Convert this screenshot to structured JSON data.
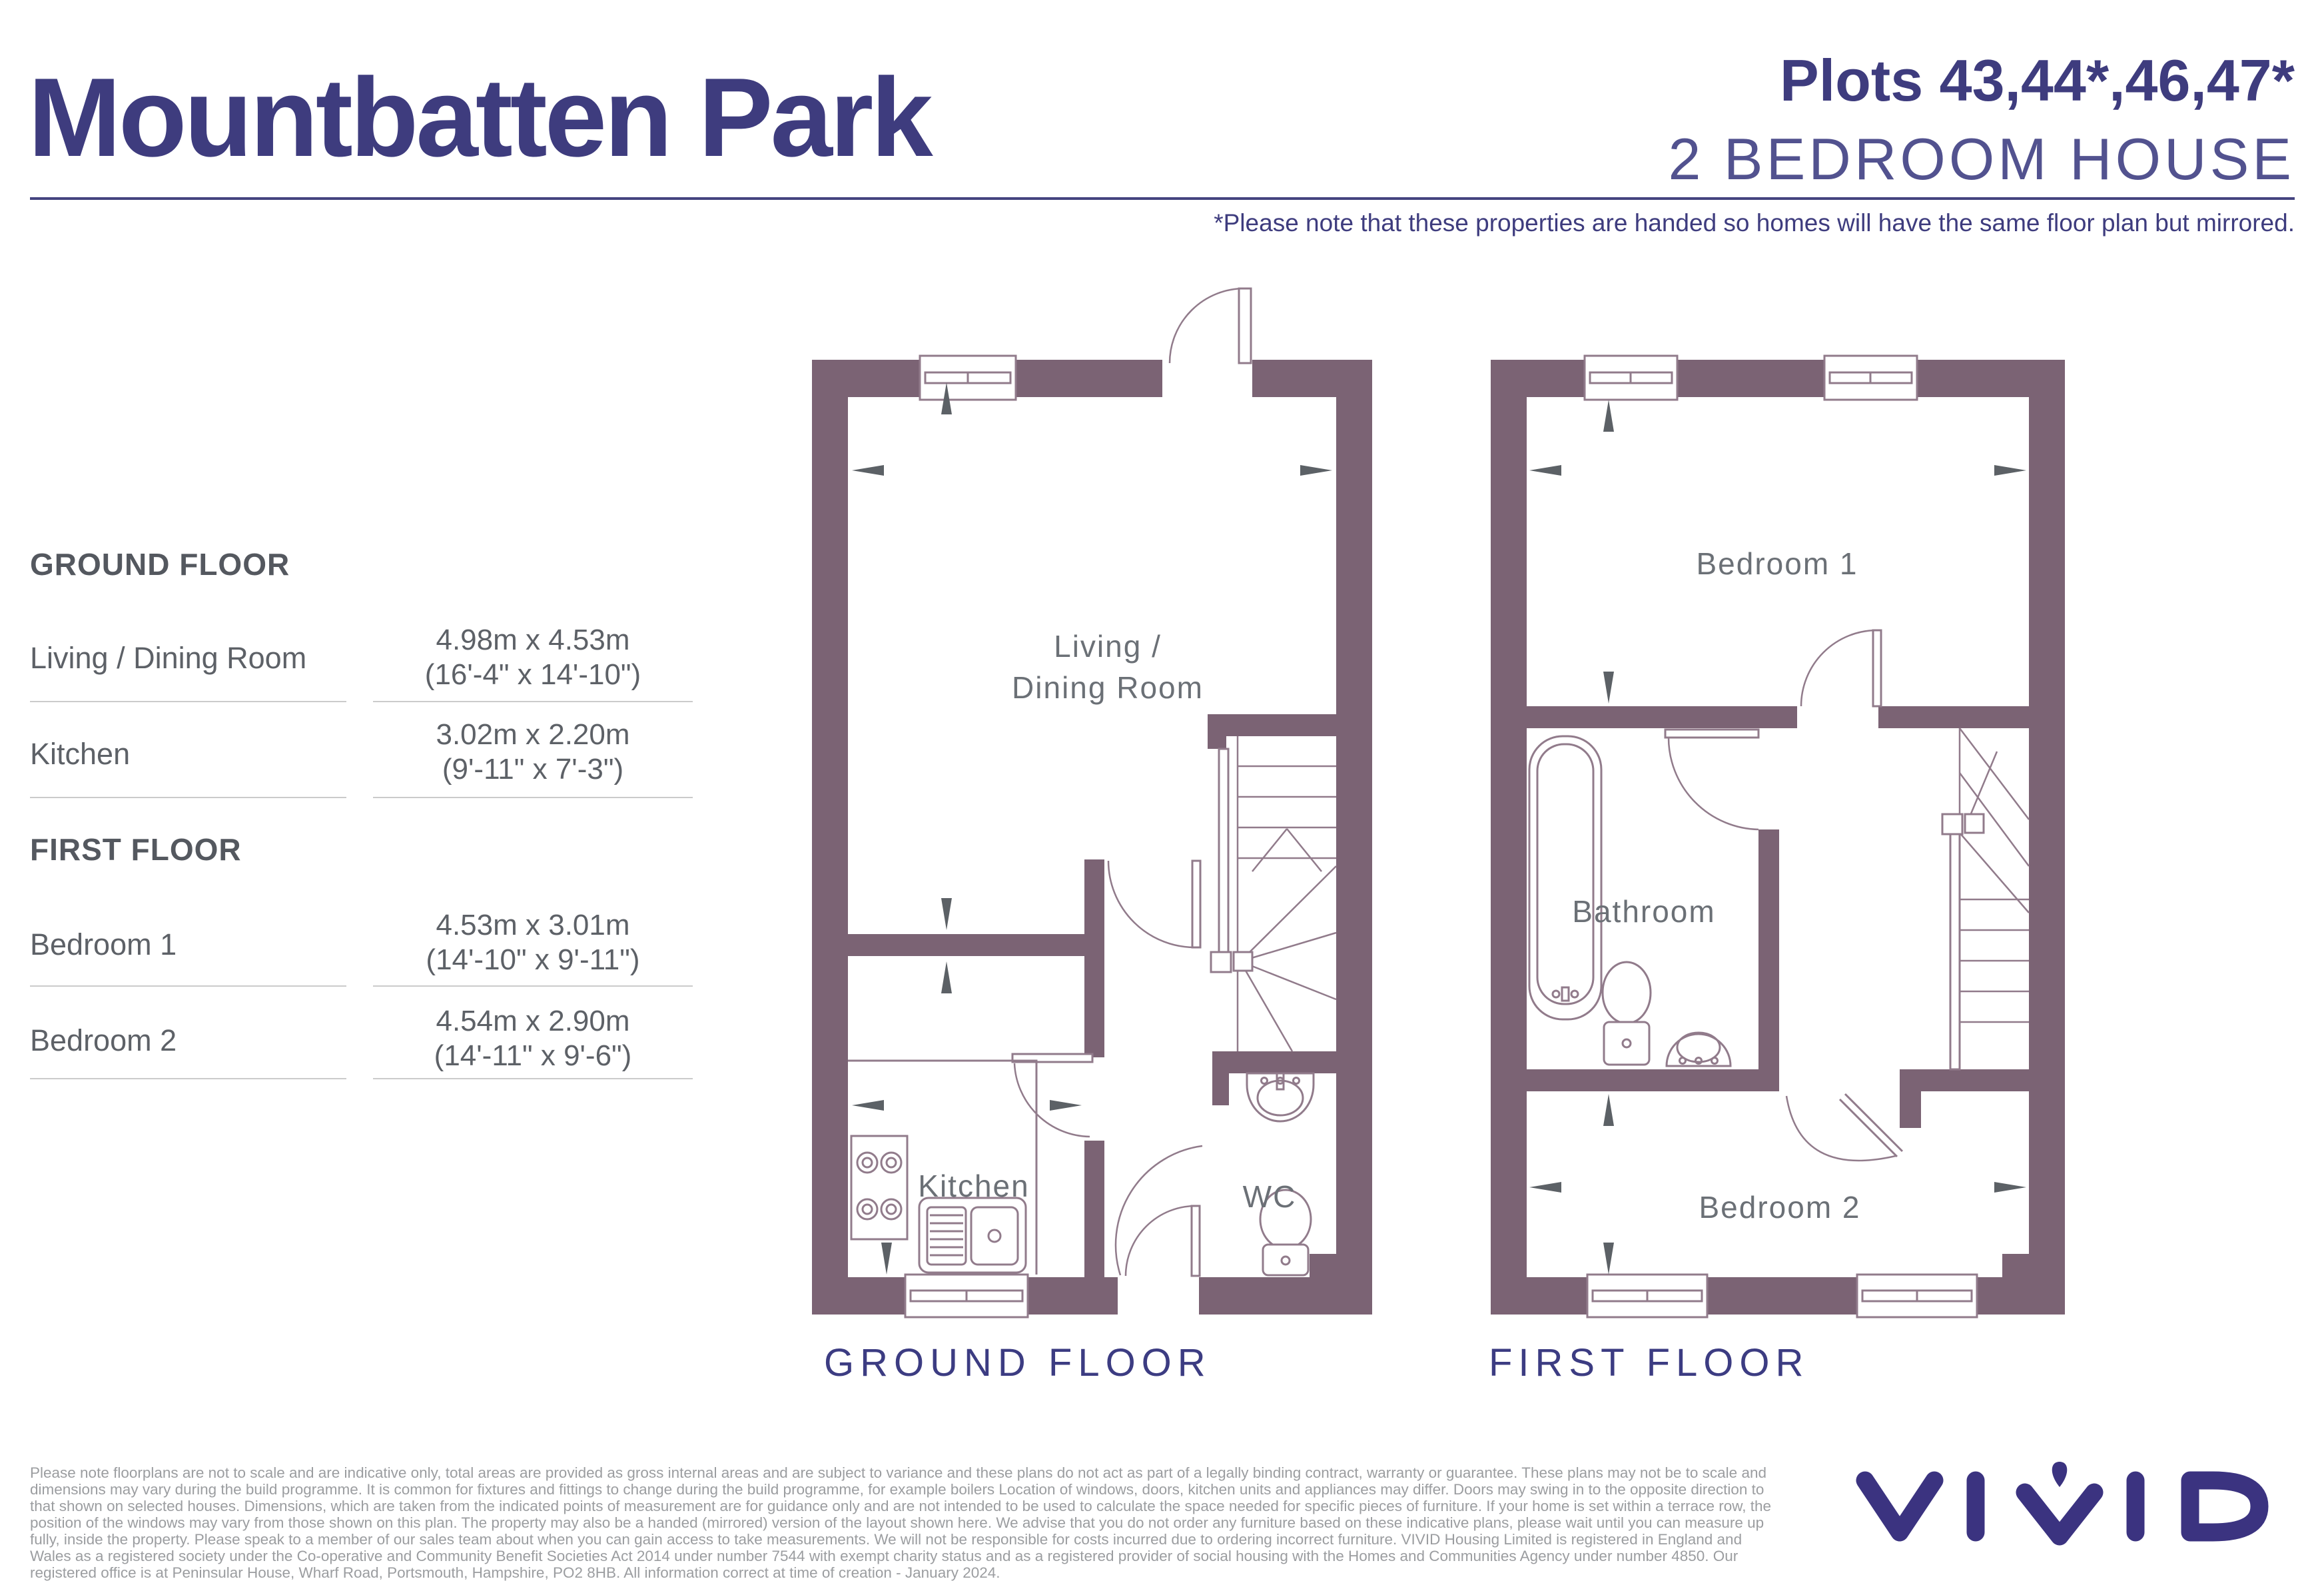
{
  "header": {
    "title": "Mountbatten Park",
    "plots": "Plots 43,44*,46,47*",
    "subtitle": "2 BEDROOM HOUSE",
    "note": "*Please note that these properties are handed so homes will have the same floor plan but mirrored."
  },
  "dimensions_table": {
    "sections": [
      {
        "heading": "GROUND FLOOR",
        "rows": [
          {
            "room": "Living / Dining Room",
            "metric": "4.98m x 4.53m",
            "imperial": "(16'-4\" x 14'-10\")"
          },
          {
            "room": "Kitchen",
            "metric": "3.02m x 2.20m",
            "imperial": "(9'-11\" x 7'-3\")"
          }
        ]
      },
      {
        "heading": "FIRST FLOOR",
        "rows": [
          {
            "room": "Bedroom 1",
            "metric": "4.53m x 3.01m",
            "imperial": "(14'-10\" x 9'-11\")"
          },
          {
            "room": "Bedroom 2",
            "metric": "4.54m x 2.90m",
            "imperial": "(14'-11\" x 9'-6\")"
          }
        ]
      }
    ]
  },
  "floorplans": {
    "ground": {
      "caption": "GROUND FLOOR",
      "labels": {
        "living_line1": "Living  /",
        "living_line2": "Dining Room",
        "kitchen": "Kitchen",
        "wc": "WC"
      }
    },
    "first": {
      "caption": "FIRST FLOOR",
      "labels": {
        "bedroom1": "Bedroom 1",
        "bathroom": "Bathroom",
        "bedroom2": "Bedroom 2"
      }
    }
  },
  "disclaimer": "Please note floorplans are not to scale and are indicative only, total areas are provided as gross internal areas and are subject to variance and these plans do not act as part of a legally binding contract, warranty or guarantee. These plans may not be to scale and dimensions may vary during the build programme. It is common for fixtures and fittings to change during the build programme, for example boilers Location of windows, doors, kitchen units and appliances may differ. Doors may swing in to the opposite direction to that shown on selected houses. Dimensions, which are taken from the indicated points of measurement are for guidance only and are not intended to be used to calculate the space needed for specific pieces of furniture. If your home is set within a terrace row, the position of the windows may vary from those shown on this plan. The property may also be a handed (mirrored) version of the layout shown here. We advise that you do not order any furniture based on these indicative plans, please wait until you can measure up fully, inside the property. Please speak to a member of our sales team about when you can gain access to take measurements. We will not be responsible for costs incurred due to ordering incorrect furniture. VIVID Housing Limited is registered in England and Wales as a registered society under the Co-operative and Community Benefit Societies Act 2014 under number 7544 with exempt charity status and as a registered provider of social housing with the Homes and Communities Agency under number 4850. Our registered office is at Peninsular House, Wharf Road, Portsmouth, Hampshire, PO2 8HB. All information correct at time of creation - January 2024.",
  "logo": {
    "brand": "VIVID"
  },
  "colors": {
    "navy": "#3e3c7e",
    "wall_purple": "#7b6374",
    "fixture_line": "#917b8b",
    "room_label_gray": "#6b7076",
    "table_gray": "#5d6167",
    "disclaimer_gray": "#9b9da0"
  }
}
